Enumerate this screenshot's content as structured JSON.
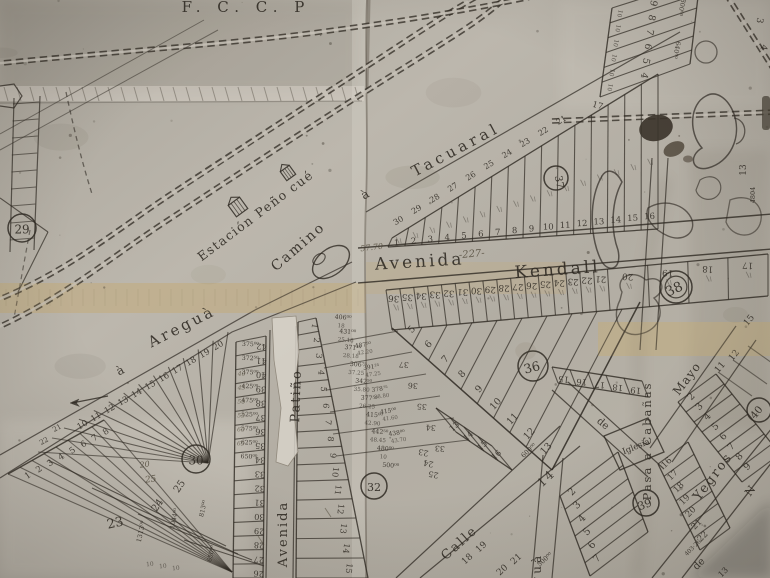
{
  "photo": {
    "paper": "#b7b2a8",
    "paper_light": "#d6d1c7",
    "paper_dark": "#8d877c",
    "tape": "#c3ac7d",
    "ink": "#2f2a23",
    "pencil_color": "#4e4737"
  },
  "railway": {
    "label": "F. C. C. P"
  },
  "station": {
    "label": "Estación Peño cué"
  },
  "streets": {
    "tacuaral_a": "à",
    "tacuaral": "Tacuaral",
    "kendall_avenida": "Avenida",
    "kendall": "Kendall",
    "camino": "Camino",
    "aregua_a": "à",
    "aregua": "Areguà",
    "patino": "Patiño",
    "patino_avenida": "Avenida",
    "calle": "Calle",
    "yegros": "Yegros",
    "cabanas": "Pasa a Cabañas",
    "mayo": "Mayo",
    "ngua": "nguà",
    "de_upper": "de",
    "de_lower": "de",
    "n_fragment": "N"
  },
  "labels": {
    "iglesia": "Iglesia",
    "bottom_13": "13"
  },
  "annotations": {
    "width_note": "57.70",
    "lot_note": "-227-",
    "pencil_a": "25",
    "pencil_b": "20"
  },
  "circles": {
    "b29": "29",
    "b30": "30",
    "b32": "32",
    "b36": "36",
    "b37": "37",
    "b38": "38",
    "b39": "39",
    "b40": "40"
  },
  "rows": {
    "kendall_north": [
      "1",
      "2",
      "3",
      "4",
      "5",
      "6",
      "7",
      "8",
      "9",
      "10",
      "11",
      "12",
      "13",
      "14",
      "15",
      "16"
    ],
    "hyp_widths": [
      "30",
      "29",
      "28",
      "27",
      "26",
      "25",
      "24",
      "23",
      "22",
      "21"
    ],
    "kendall_south": [
      "36",
      "35",
      "34",
      "33",
      "32",
      "31",
      "30",
      "29",
      "28",
      "27",
      "26",
      "25",
      "24",
      "23",
      "22",
      "21",
      "20",
      "19",
      "18",
      "17"
    ],
    "top_right": {
      "lots": [
        "4",
        "5",
        "6",
        "7",
        "8",
        "9"
      ],
      "width": "10",
      "values": [
        "640⁰⁰",
        "800⁰⁰"
      ],
      "n17": "17",
      "n13": "13",
      "v4804": "4804"
    },
    "corner_ne": [
      "3",
      "4"
    ],
    "aregua_row": [
      "20",
      "19",
      "18",
      "17",
      "16",
      "15",
      "14",
      "13",
      "12",
      "11",
      "10"
    ],
    "aregua_ext": [
      "21",
      "22"
    ],
    "big_lots": {
      "numbers": [
        "23",
        "24",
        "25"
      ],
      "values": [
        "1313⁰⁰",
        "813⁰⁰",
        "1044⁰⁰",
        "650⁰⁰"
      ],
      "ticks": [
        "10",
        "10",
        "10"
      ]
    },
    "fan8": [
      "8",
      "7",
      "6",
      "5",
      "4",
      "3",
      "2",
      "1"
    ],
    "patino_col": {
      "numbers": [
        "42",
        "41",
        "40",
        "39",
        "38",
        "37",
        "36",
        "35",
        "34",
        "33",
        "32",
        "31",
        "30",
        "29",
        "28",
        "27",
        "26"
      ],
      "values": [
        "375⁰⁰",
        "372⁵⁰",
        "375⁰⁰",
        "425⁰⁰",
        "475⁰⁰",
        "525⁰⁰",
        "575⁰⁰",
        "625⁰⁰",
        "650⁰⁰"
      ],
      "pencil": [
        "40",
        "45",
        "50",
        "55",
        "60",
        "65"
      ]
    },
    "fan32": {
      "numbers": [
        "1",
        "2",
        "3",
        "4",
        "5",
        "6",
        "7",
        "8",
        "9",
        "10",
        "11",
        "12",
        "13",
        "14",
        "15"
      ],
      "values": [
        "406⁰⁰",
        "431⁰⁰",
        "371²⁵",
        "306⁷⁵",
        "342⁵⁰",
        "377⁵⁰",
        "415⁰⁰",
        "442⁵⁰",
        "480⁰⁰",
        "500⁰⁰"
      ],
      "subs": [
        "18",
        "25.18",
        "28.18",
        "37.25",
        "35.80",
        "26.25",
        "42.90",
        "48.45",
        "10",
        ""
      ]
    },
    "west_col": {
      "values": [
        "487⁵⁰",
        "391²⁵",
        "378⁷⁵",
        "415⁰⁰",
        "438⁰⁰"
      ],
      "subs": [
        "42.20",
        "47.25",
        "38.80",
        "41.60",
        "43.70"
      ],
      "numbers": [
        "37",
        "36",
        "35",
        "34",
        "33"
      ]
    },
    "mid_col": [
      "23",
      "24",
      "25"
    ],
    "block36": {
      "left": [
        "5",
        "6",
        "7",
        "8",
        "9",
        "10",
        "11",
        "12",
        "13"
      ],
      "south": [
        "15",
        "16",
        "17",
        "18",
        "19"
      ]
    },
    "south_row": {
      "numbers": [
        "13",
        "14",
        "15",
        "16"
      ],
      "value": "600⁰⁰",
      "street_number": "14"
    },
    "calle_lots": {
      "nw": [
        "18",
        "19"
      ],
      "se": [
        "20",
        "21"
      ],
      "value": "500⁰⁰"
    },
    "bottom_center_col": [
      "2",
      "3",
      "4",
      "5",
      "6",
      "7"
    ],
    "yegros_ne": [
      "2",
      "3",
      "4",
      "5",
      "6",
      "7",
      "8",
      "9"
    ],
    "yegros_sw": {
      "numbers": [
        "16",
        "17",
        "18",
        "19",
        "20",
        "21",
        "22"
      ],
      "value": "403·26"
    }
  },
  "right_mid": [
    "11",
    "12",
    "15"
  ]
}
